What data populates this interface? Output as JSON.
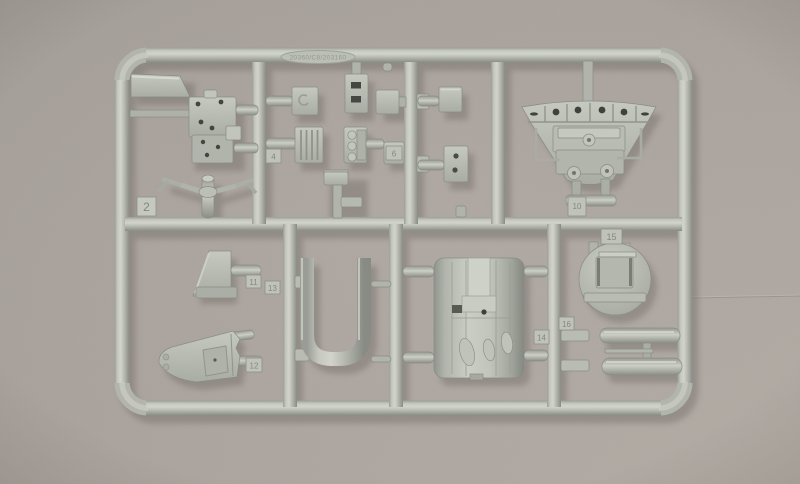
{
  "meta": {
    "subject": "Photograph of an injection-molded scale model kit sprue (parts frame) of light gray plastic, lying on a warm gray surface"
  },
  "colors": {
    "plastic_base": "#b4b7ae",
    "plastic_light": "#cdd0c7",
    "plastic_dark": "#878b83",
    "background_from": "#a39d97",
    "background_to": "#b2aba4",
    "shadow": "#5f5952"
  },
  "sprue": {
    "mold_text": "20360/C8/203160",
    "frame_number": "2",
    "tabs": [
      {
        "label": "4"
      },
      {
        "label": "6"
      },
      {
        "label": "10"
      },
      {
        "label": "15"
      },
      {
        "label": "14"
      },
      {
        "label": "11"
      },
      {
        "label": "13"
      },
      {
        "label": "12"
      },
      {
        "label": "16"
      }
    ],
    "parts": [
      {
        "name": "corner-wedge",
        "desc": "flat wedge plate molded into top-left frame corner"
      },
      {
        "name": "floor-panel",
        "desc": "rectangular cockpit floor panel with drilled holes"
      },
      {
        "name": "control-yoke",
        "desc": "control column with two drooping handle arms"
      },
      {
        "name": "access-panel",
        "desc": "small flat hatch panel"
      },
      {
        "name": "slotted-bracket",
        "desc": "vertical bracket with two rectangular slots"
      },
      {
        "name": "louver-box",
        "desc": "ribbed louvered box"
      },
      {
        "name": "knob-stack",
        "desc": "stepped block with three round bosses"
      },
      {
        "name": "small-boxes",
        "desc": "assorted small box fittings"
      },
      {
        "name": "pedestal",
        "desc": "T-shaped pedestal part"
      },
      {
        "name": "holed-plate",
        "desc": "small plate with two holes"
      },
      {
        "name": "bulkhead",
        "desc": "large fan-shaped firewall bulkhead with piping and round bosses"
      },
      {
        "name": "mount-trapezoid",
        "desc": "trapezoidal mount block"
      },
      {
        "name": "hull-fairing",
        "desc": "boat-hull shaped fairing with recessed panel"
      },
      {
        "name": "u-channel",
        "desc": "large U-shaped frame channel"
      },
      {
        "name": "fuselage-section",
        "desc": "cylindrical fuselage barrel section with panel lines and oval bumps"
      },
      {
        "name": "disc-bulkhead",
        "desc": "round former disc with rectangular box and shelf"
      },
      {
        "name": "twin-cylinders",
        "desc": "two torpedo-shaped cylinders joined by a thin vane"
      }
    ]
  }
}
